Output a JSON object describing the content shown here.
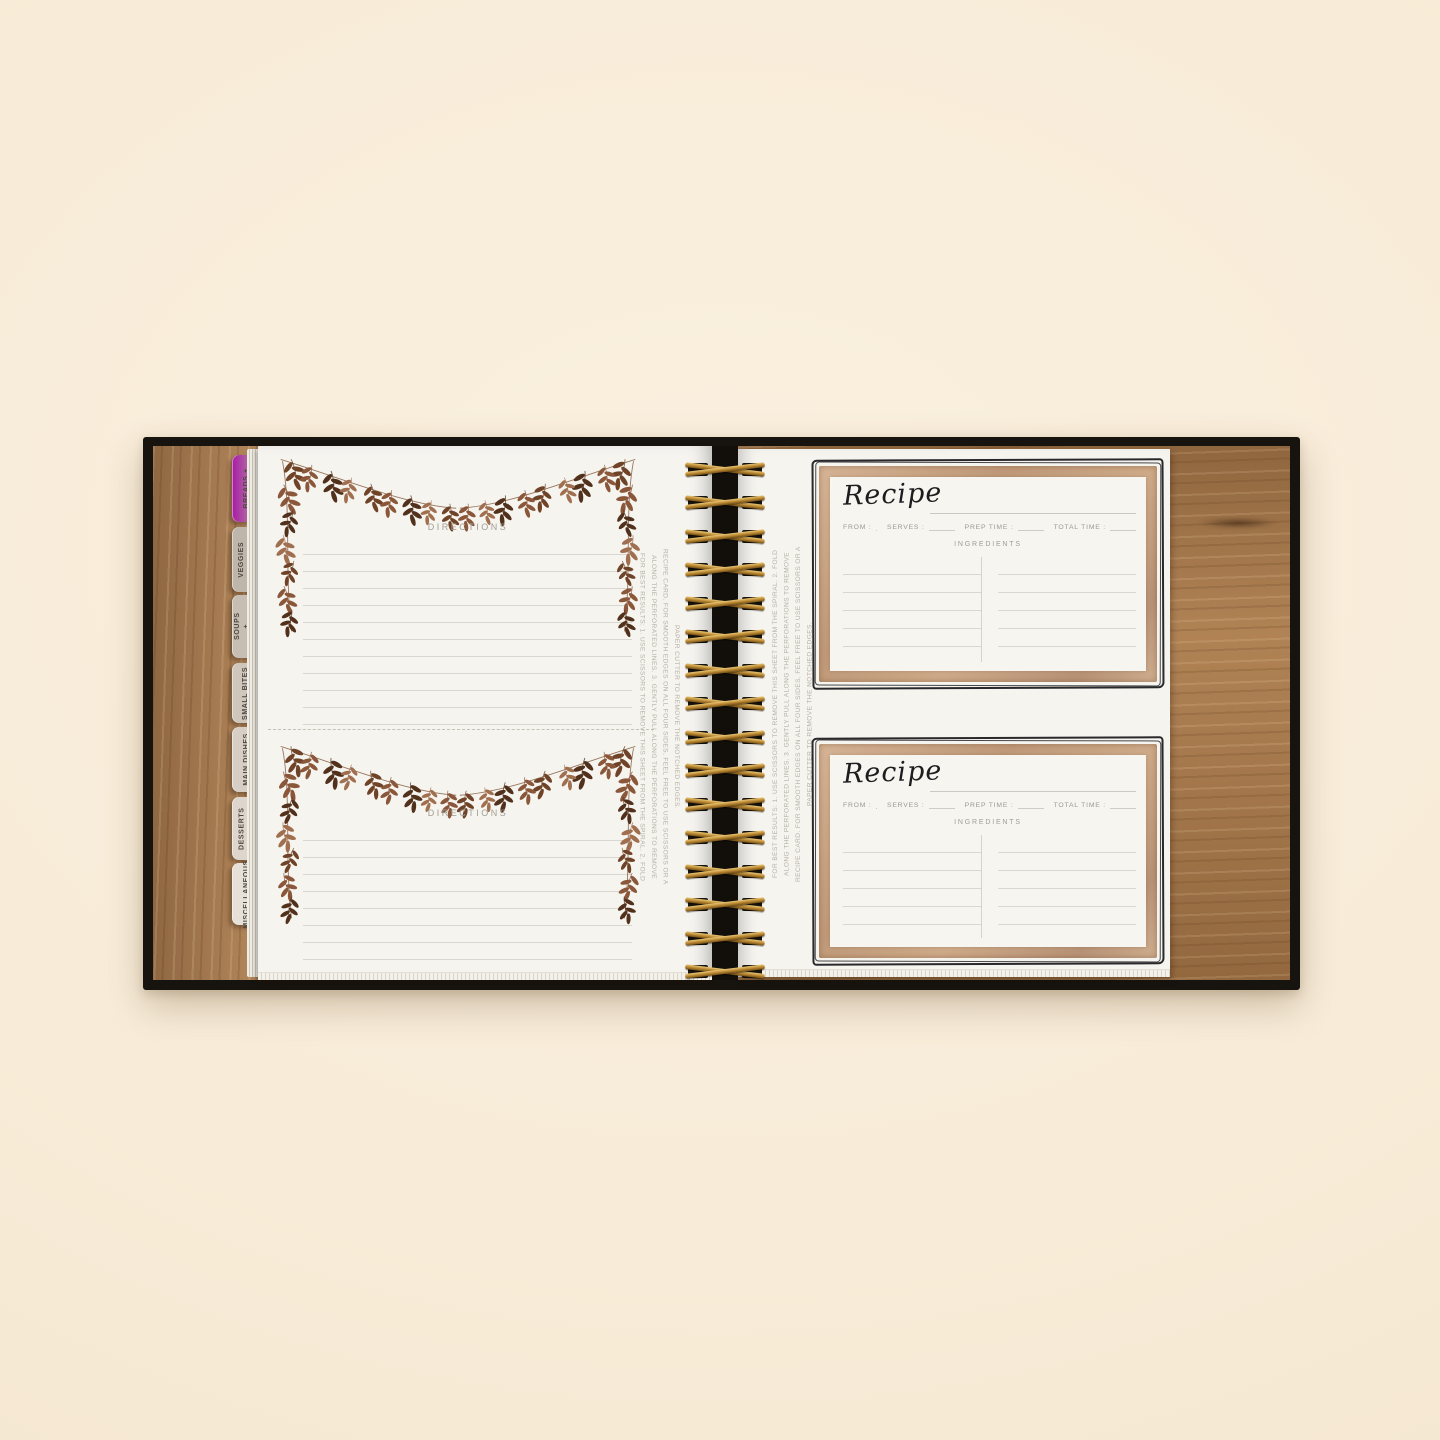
{
  "photo": {
    "background_color": "#f8edda",
    "cover_color": "#17130e",
    "wood_color": "#a87a4d",
    "coil_color": "#b5842f",
    "card_frame_color": "#c09a79"
  },
  "book": {
    "tabs": [
      {
        "label": "BREADS +"
      },
      {
        "label": "VEGGIES + SIDES"
      },
      {
        "label": "SOUPS + SALADS"
      },
      {
        "label": "SMALL BITES"
      },
      {
        "label": "MAIN DISHES"
      },
      {
        "label": "DESSERTS + DRINKS"
      },
      {
        "label": "MISCELLANEOUS"
      }
    ],
    "left_page": {
      "cards": [
        {
          "heading": "DIRECTIONS"
        },
        {
          "heading": "DIRECTIONS"
        }
      ],
      "removal_note": "FOR BEST RESULTS: 1. USE SCISSORS TO REMOVE THIS SHEET FROM THE SPIRAL. 2. FOLD ALONG THE PERFORATED LINES. 3. GENTLY PULL ALONG THE PERFORATIONS TO REMOVE RECIPE CARD. FOR SMOOTH EDGES ON ALL FOUR SIDES, FEEL FREE TO USE SCISSORS OR A PAPER CUTTER TO REMOVE THE NOTCHED EDGES."
    },
    "right_page": {
      "removal_note": "FOR BEST RESULTS: 1. USE SCISSORS TO REMOVE THIS SHEET FROM THE SPIRAL. 2. FOLD ALONG THE PERFORATED LINES. 3. GENTLY PULL ALONG THE PERFORATIONS TO REMOVE RECIPE CARD. FOR SMOOTH EDGES ON ALL FOUR SIDES, FEEL FREE TO USE SCISSORS OR A PAPER CUTTER TO REMOVE THE NOTCHED EDGES.",
      "cards": [
        {
          "title": "Recipe",
          "from_label": "FROM :",
          "serves_label": "SERVES :",
          "prep_label": "PREP TIME :",
          "total_label": "TOTAL TIME :",
          "ingredients_label": "INGREDIENTS"
        },
        {
          "title": "Recipe",
          "from_label": "FROM :",
          "serves_label": "SERVES :",
          "prep_label": "PREP TIME :",
          "total_label": "TOTAL TIME :",
          "ingredients_label": "INGREDIENTS"
        }
      ]
    }
  }
}
